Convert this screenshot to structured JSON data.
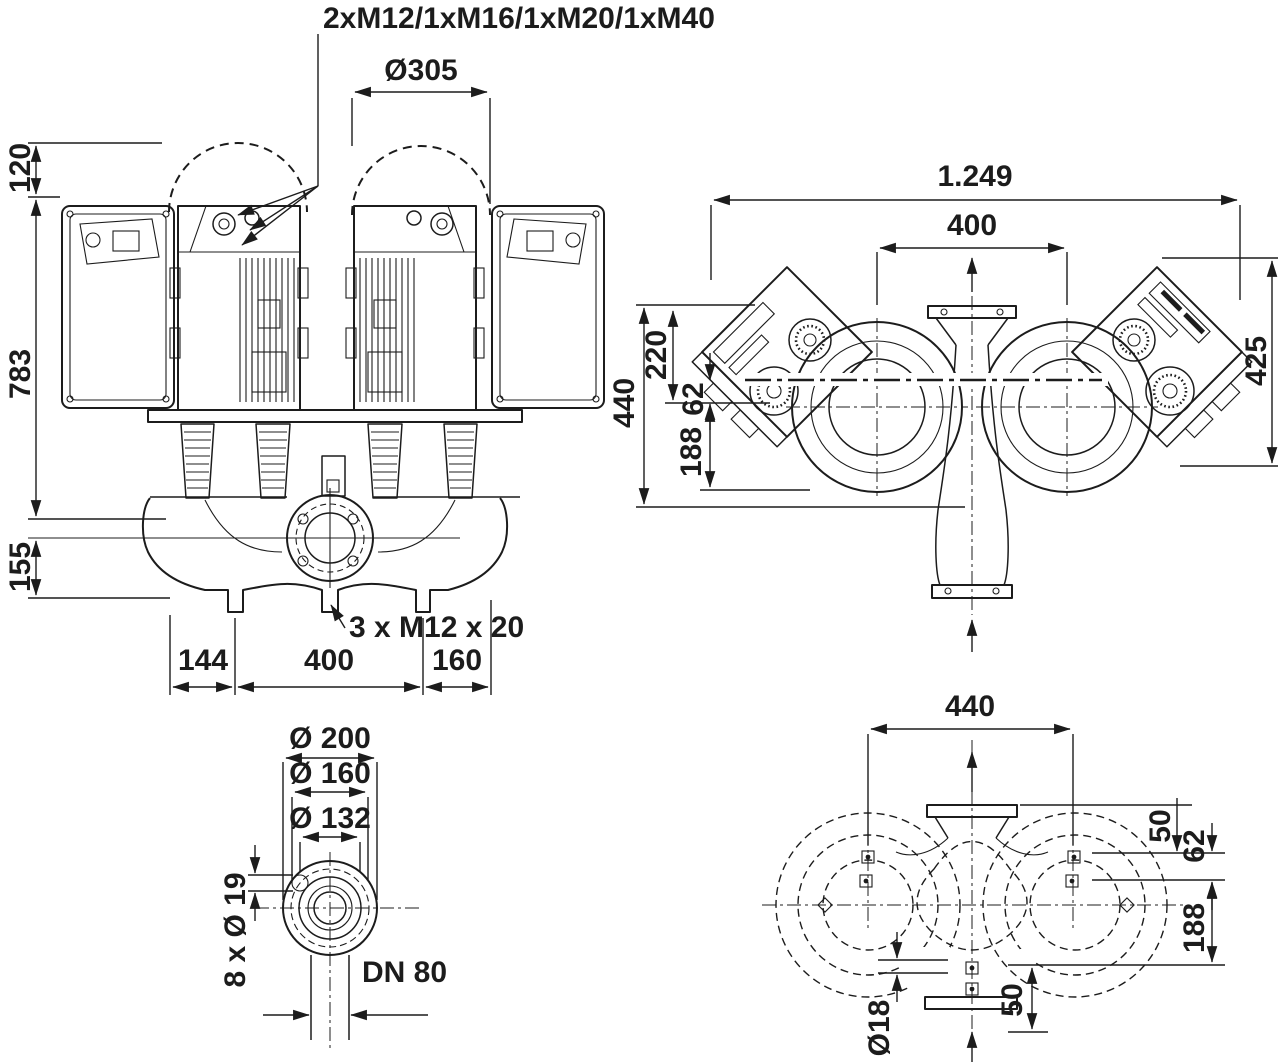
{
  "colors": {
    "line": "#1c1c1c",
    "background": "#ffffff"
  },
  "front_view": {
    "cable_glands_label": "2xM12/1xM16/1xM20/1xM40",
    "motor_clearance_diameter": "Ø305",
    "clearance_height": "120",
    "pump_height": "783",
    "base_height": "155",
    "dim_left_edge_to_port": "144",
    "dim_port_spacing": "400",
    "dim_port_to_right_edge": "160",
    "tapping_label": "3 x M12 x 20"
  },
  "top_view": {
    "overall_width": "1.249",
    "motor_spacing": "400",
    "depth_right": "425",
    "overall_depth": "440",
    "front_depth": "220",
    "axis_offset": "62",
    "rear_depth": "188"
  },
  "flange_detail": {
    "outer_diameter": "Ø 200",
    "bolt_circle_diameter": "Ø 160",
    "raised_face_diameter": "Ø 132",
    "bolt_holes": "8 x Ø 19",
    "nominal_diameter": "DN 80"
  },
  "base_plan_view": {
    "bolt_span": "440",
    "dim_50_upper": "50",
    "dim_62": "62",
    "dim_188": "188",
    "dim_50_lower": "50",
    "anchor_hole_diameter": "Ø18"
  }
}
